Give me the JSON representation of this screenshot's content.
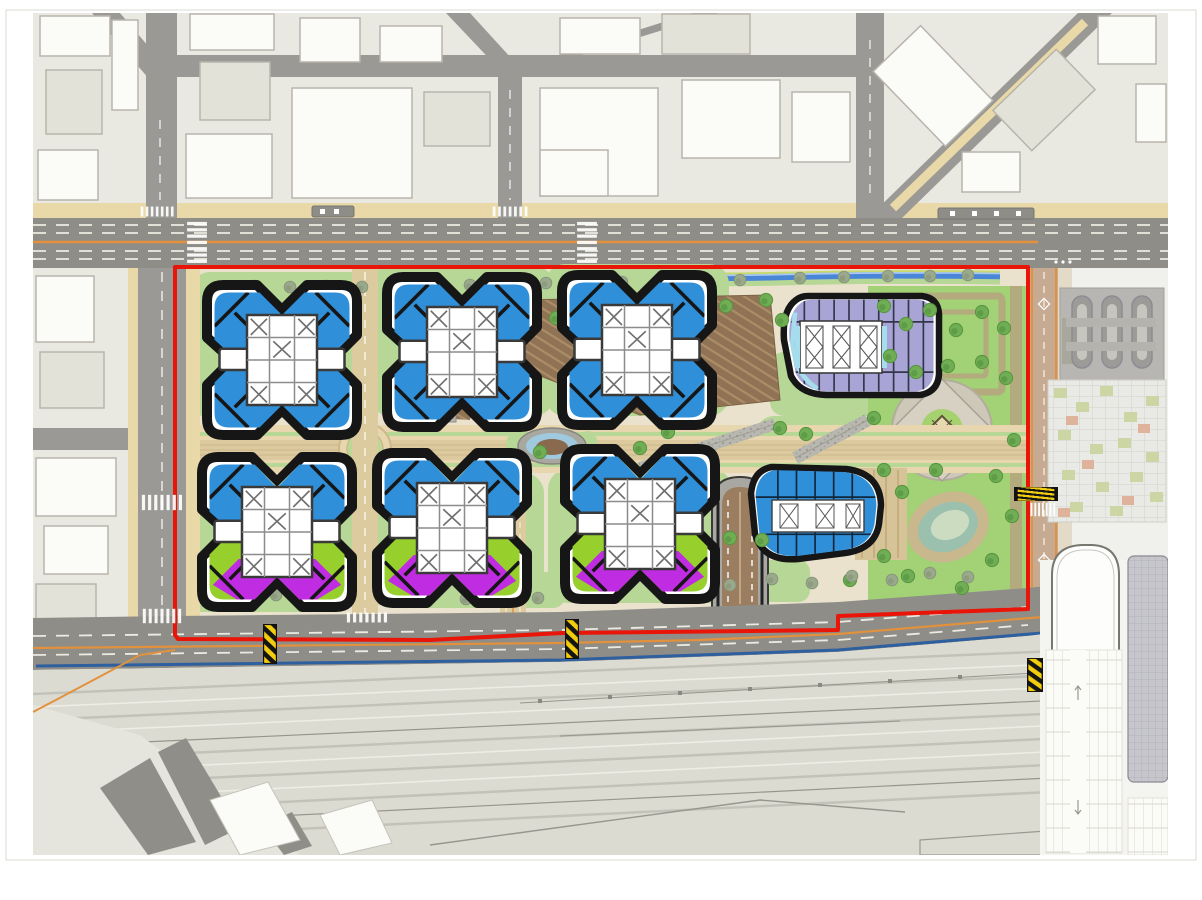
{
  "meta": {
    "drawing_type": "architectural-master-plan",
    "description_elements": [
      "urban-context",
      "main-boulevard",
      "site-boundary",
      "residential-towers",
      "stadium-podium-building",
      "oval-building",
      "central-promenade",
      "park-plaza",
      "pond",
      "rail-yard",
      "bus-terminal",
      "station-parking"
    ]
  },
  "colors": {
    "paper": "#ffffff",
    "frame": "#d9d8d3",
    "urban": "#e9e8e1",
    "bldg": "#fbfbf8",
    "bldgTint": "#e3e2d8",
    "bldgEdge": "#b7b5ac",
    "road": "#9a9995",
    "blvd": "#8e8d88",
    "sand": "#ead9a8",
    "siteBase": "#eae2cd",
    "lawn": "#b6d795",
    "lawnPale": "#cde4b2",
    "parkGreen": "#a2d176",
    "olive": "#b3aa7e",
    "stream": "#4a86d8",
    "streamHi": "#a9c8ec",
    "treeG": "#6fae54",
    "treeGd": "#4e8a3c",
    "treeS": "#9aa88c",
    "treeSd": "#7f8f72",
    "towerBlue": "#2f8fd8",
    "lime": "#97d02c",
    "magenta": "#c02ce2",
    "lavender": "#a8a5d6",
    "cyan": "#a5dded",
    "brown": "#8f7354",
    "brownLine": "#ab8d68",
    "promenade": "#e8d7ae",
    "promMid": "#dcc99e",
    "cobble": "#b9b8b0",
    "red": "#e81508",
    "orange": "#e2913c",
    "blueLine": "#2e5f9e",
    "rail": "#dcdbd2",
    "track": "#c3c2b9",
    "trackLight": "#efeee6",
    "trackDark": "#97968e",
    "roadTan": "#c6ab92",
    "rampBrown": "#9b7e5f",
    "outline": "#161616",
    "stationGray": "#c6c6cc",
    "mosaic": "#e9e9e5",
    "mosaicGreen": "#ccd6a4",
    "mosaicSalmon": "#deb29b",
    "hazYellow": "#f2cc0e"
  },
  "instances": [
    {
      "symbol": "treeG",
      "size": 17,
      "points": [
        [
          232,
          312
        ],
        [
          258,
          322
        ],
        [
          320,
          318
        ],
        [
          345,
          308
        ],
        [
          418,
          302
        ],
        [
          438,
          315
        ],
        [
          528,
          306
        ],
        [
          556,
          318
        ],
        [
          610,
          302
        ],
        [
          700,
          318
        ],
        [
          726,
          306
        ],
        [
          766,
          300
        ],
        [
          782,
          320
        ],
        [
          250,
          428
        ],
        [
          300,
          398
        ],
        [
          338,
          425
        ],
        [
          422,
          455
        ],
        [
          540,
          452
        ],
        [
          588,
          420
        ],
        [
          668,
          432
        ],
        [
          700,
          455
        ],
        [
          780,
          428
        ],
        [
          806,
          434
        ],
        [
          240,
          468
        ],
        [
          330,
          464
        ],
        [
          640,
          448
        ],
        [
          730,
          538
        ],
        [
          762,
          540
        ],
        [
          238,
          560
        ],
        [
          300,
          566
        ],
        [
          480,
          556
        ],
        [
          520,
          562
        ],
        [
          660,
          552
        ],
        [
          884,
          306
        ],
        [
          906,
          324
        ],
        [
          930,
          310
        ],
        [
          956,
          330
        ],
        [
          982,
          312
        ],
        [
          1004,
          328
        ],
        [
          890,
          356
        ],
        [
          916,
          372
        ],
        [
          948,
          366
        ],
        [
          982,
          362
        ],
        [
          1006,
          378
        ],
        [
          884,
          470
        ],
        [
          902,
          492
        ],
        [
          884,
          556
        ],
        [
          908,
          576
        ],
        [
          996,
          476
        ],
        [
          1012,
          516
        ],
        [
          992,
          560
        ],
        [
          962,
          588
        ],
        [
          936,
          470
        ],
        [
          1014,
          440
        ],
        [
          874,
          418
        ],
        [
          850,
          580
        ]
      ]
    },
    {
      "symbol": "treeS",
      "size": 15,
      "points": [
        [
          222,
          287
        ],
        [
          254,
          286
        ],
        [
          290,
          287
        ],
        [
          326,
          286
        ],
        [
          362,
          287
        ],
        [
          400,
          286
        ],
        [
          470,
          285
        ],
        [
          508,
          284
        ],
        [
          546,
          283
        ],
        [
          584,
          282
        ],
        [
          622,
          282
        ],
        [
          660,
          281
        ],
        [
          700,
          280
        ],
        [
          740,
          280
        ],
        [
          800,
          278
        ],
        [
          844,
          277
        ],
        [
          888,
          276
        ],
        [
          930,
          276
        ],
        [
          968,
          275
        ],
        [
          205,
          596
        ],
        [
          240,
          602
        ],
        [
          276,
          595
        ],
        [
          312,
          601
        ],
        [
          348,
          595
        ],
        [
          394,
          599
        ],
        [
          430,
          593
        ],
        [
          466,
          599
        ],
        [
          502,
          592
        ],
        [
          538,
          598
        ],
        [
          622,
          584
        ],
        [
          658,
          588
        ],
        [
          694,
          581
        ],
        [
          730,
          585
        ],
        [
          772,
          579
        ],
        [
          812,
          583
        ],
        [
          852,
          576
        ],
        [
          892,
          580
        ],
        [
          930,
          573
        ],
        [
          968,
          577
        ]
      ]
    },
    {
      "symbol": "towerA",
      "size": 200,
      "points": [
        [
          282,
          360
        ],
        [
          462,
          352
        ],
        [
          637,
          350
        ]
      ]
    },
    {
      "symbol": "towerB",
      "size": 200,
      "points": [
        [
          277,
          532
        ],
        [
          452,
          528
        ],
        [
          640,
          524
        ]
      ]
    },
    {
      "symbol": "zebraV",
      "points": [
        [
          186,
          221,
          22,
          45
        ],
        [
          576,
          221,
          22,
          45
        ]
      ]
    },
    {
      "symbol": "zebraH",
      "points": [
        [
          141,
          494,
          44,
          17
        ],
        [
          142,
          608,
          42,
          16
        ],
        [
          1030,
          502,
          27,
          15
        ],
        [
          492,
          206,
          38,
          11
        ],
        [
          140,
          206,
          36,
          11
        ],
        [
          346,
          612,
          44,
          11
        ]
      ]
    },
    {
      "symbol": "hazbar",
      "points": [
        [
          263,
          624,
          14,
          40
        ],
        [
          565,
          619,
          14,
          40
        ],
        [
          1014,
          487,
          44,
          14
        ],
        [
          1027,
          658,
          16,
          34
        ]
      ]
    }
  ]
}
